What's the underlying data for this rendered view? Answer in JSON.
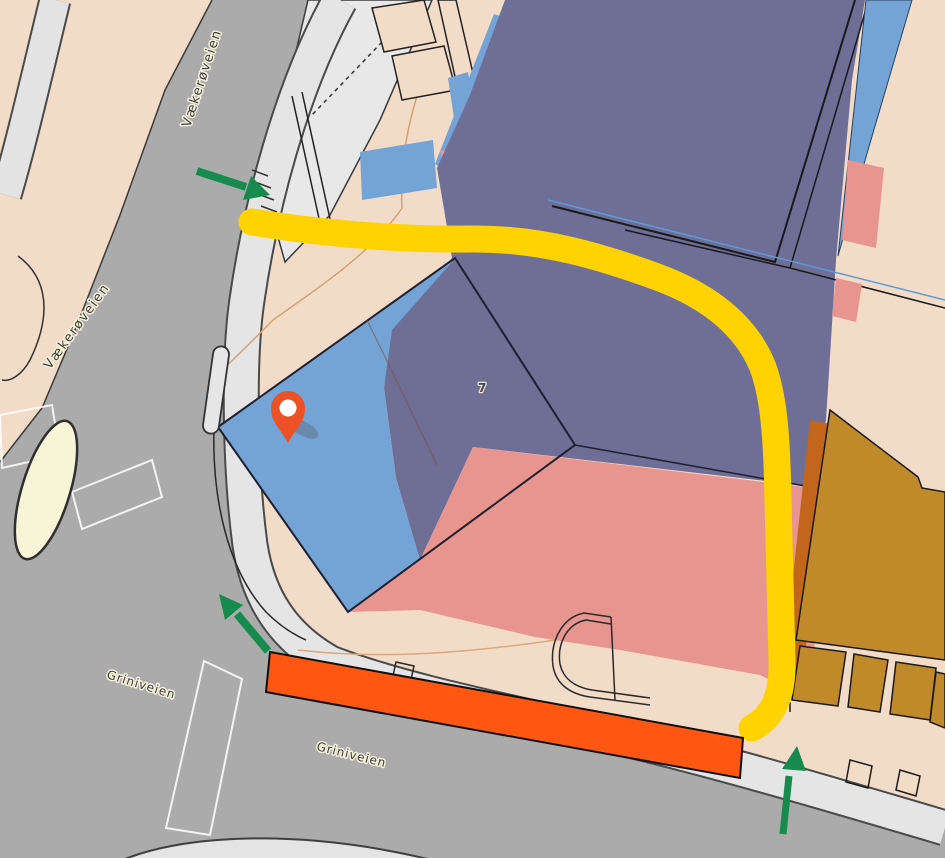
{
  "labels": {
    "street_top": "Vækerøveien",
    "street_left": "Vækerøveien",
    "street_bottom_1": "Griniveien",
    "street_bottom_2": "Griniveien",
    "building_number": "7"
  },
  "colors": {
    "route_yellow": "#FFD303",
    "closure_orange": "#FF5712",
    "arrow_green": "#178A4E",
    "pin_orange": "#ED5226",
    "building_blue": "#74A3D6",
    "building_purple": "#6E6E97",
    "building_pink": "#E8958F",
    "building_ochre": "#C08A2B",
    "building_ochre_edge": "#C2661C",
    "road_gray": "#ABABAB",
    "sidewalk_gray": "#E5E5E5",
    "land_peach": "#F2DCC8",
    "island_cream": "#F8F4D8"
  }
}
